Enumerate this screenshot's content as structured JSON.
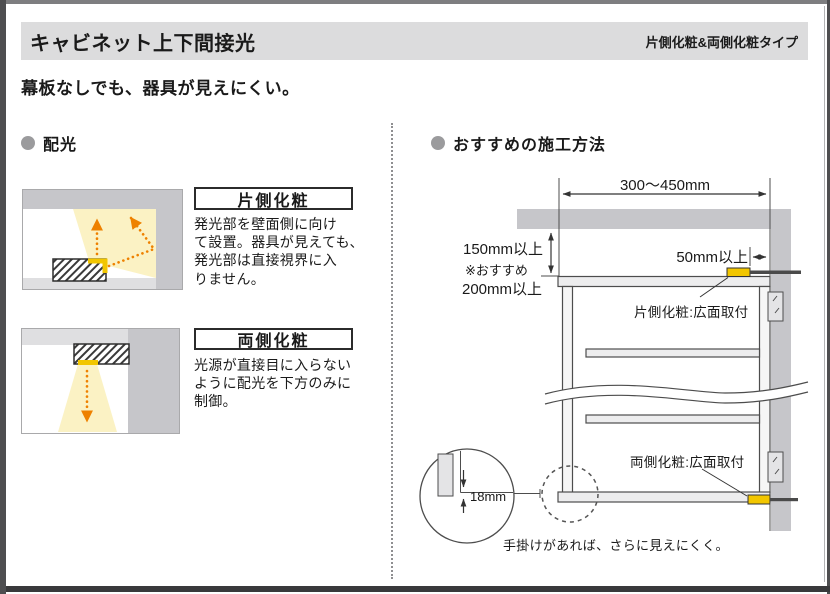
{
  "header": {
    "title": "キャビネット上下間接光",
    "type_label": "片側化粧&両側化粧タイプ"
  },
  "lead": "幕板なしでも、器具が見えにくい。",
  "distribution": {
    "title": "配光",
    "items": [
      {
        "label": "片側化粧",
        "description": "発光部を壁面側に向け\nて設置。器具が見えても、\n発光部は直接視界に入\nりません。"
      },
      {
        "label": "両側化粧",
        "description": "光源が直接目に入らない\nように配光を下方のみに\n制御。"
      }
    ]
  },
  "installation": {
    "title": "おすすめの施工方法",
    "dimensions": {
      "top_width": "300〜450mm",
      "clearance_min": "150mm以上",
      "clearance_note": "※おすすめ",
      "clearance_recommended": "200mm以上",
      "side_clearance": "50mm以上",
      "panel_thickness": "18mm"
    },
    "labels": {
      "top_fixture": "片側化粧:広面取付",
      "bottom_fixture": "両側化粧:広面取付",
      "handle_note": "手掛けがあれば、さらに見えにくく。"
    }
  },
  "colors": {
    "fixture_yellow": "#f2c600",
    "light_beam_yellow": "#fbf2c4",
    "arrow_orange": "#ee8100",
    "wall_gray": "#c6c6ca",
    "header_gray": "#dcdcdd"
  }
}
